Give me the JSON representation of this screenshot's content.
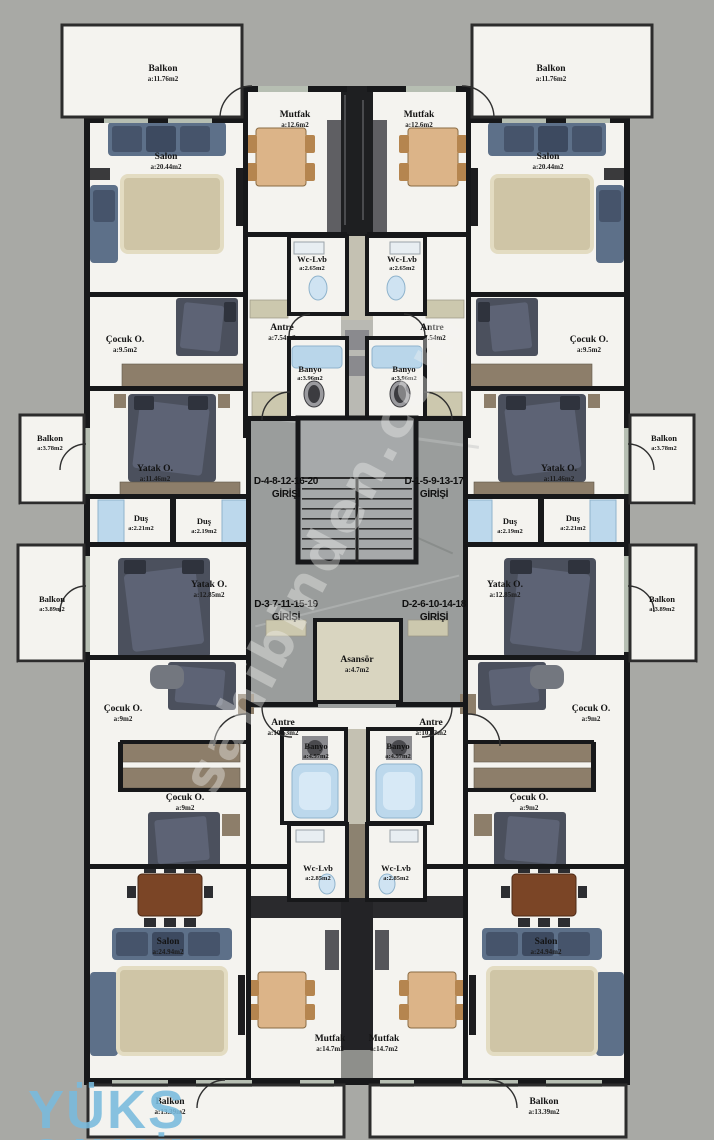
{
  "watermark": "sahibinden.com",
  "logo": {
    "line1": "YÜKS",
    "line2": "GAYRİM"
  },
  "colors": {
    "background": "#a8a9a5",
    "wall": "#17181a",
    "floor": "#f4f3ef",
    "stair_core": "#9a9d9c",
    "elevator_fill": "#d9d5c0",
    "wood": "#8d7e6a",
    "sofa": "#5d7089",
    "bed": "#4b505d",
    "rug": "#cfc5a6",
    "fixture_blue": "#bcd8ec",
    "logo_blue": "#79bbdd"
  },
  "entrances": {
    "top_left": {
      "line1": "D-4-8-12-16-20",
      "line2": "GİRİŞİ"
    },
    "top_right": {
      "line1": "D-1-5-9-13-17",
      "line2": "GİRİŞİ"
    },
    "bottom_left": {
      "line1": "D-3-7-11-15-19",
      "line2": "GİRİŞİ"
    },
    "bottom_right": {
      "line1": "D-2-6-10-14-18",
      "line2": "GİRİŞİ"
    }
  },
  "rooms": {
    "balkon_tl": {
      "name": "Balkon",
      "area": "a:11.76m2"
    },
    "balkon_tr": {
      "name": "Balkon",
      "area": "a:11.76m2"
    },
    "salon_tl": {
      "name": "Salon",
      "area": "a:20.44m2"
    },
    "salon_tr": {
      "name": "Salon",
      "area": "a:20.44m2"
    },
    "mutfak_tl": {
      "name": "Mutfak",
      "area": "a:12.6m2"
    },
    "mutfak_tr": {
      "name": "Mutfak",
      "area": "a:12.6m2"
    },
    "wclvb_tl": {
      "name": "Wc-Lvb",
      "area": "a:2.65m2"
    },
    "wclvb_tr": {
      "name": "Wc-Lvb",
      "area": "a:2.65m2"
    },
    "antre_tl": {
      "name": "Antre",
      "area": "a:7.54m2"
    },
    "antre_tr": {
      "name": "Antre",
      "area": "a:7.54m2"
    },
    "banyo_tl": {
      "name": "Banyo",
      "area": "a:3.96m2"
    },
    "banyo_tr": {
      "name": "Banyo",
      "area": "a:3.96m2"
    },
    "cocuk_tl": {
      "name": "Çocuk O.",
      "area": "a:9.5m2"
    },
    "cocuk_tr": {
      "name": "Çocuk O.",
      "area": "a:9.5m2"
    },
    "balkon_ml1": {
      "name": "Balkon",
      "area": "a:3.78m2"
    },
    "balkon_mr1": {
      "name": "Balkon",
      "area": "a:3.78m2"
    },
    "yatak_tl": {
      "name": "Yatak O.",
      "area": "a:11.46m2"
    },
    "yatak_tr": {
      "name": "Yatak O.",
      "area": "a:11.46m2"
    },
    "dus_l1": {
      "name": "Duş",
      "area": "a:2.21m2"
    },
    "dus_l2": {
      "name": "Duş",
      "area": "a:2.19m2"
    },
    "dus_r1": {
      "name": "Duş",
      "area": "a:2.19m2"
    },
    "dus_r2": {
      "name": "Duş",
      "area": "a:2.21m2"
    },
    "yatak_ml": {
      "name": "Yatak O.",
      "area": "a:12.85m2"
    },
    "yatak_mr": {
      "name": "Yatak O.",
      "area": "a:12.85m2"
    },
    "balkon_ml2": {
      "name": "Balkon",
      "area": "a:3.89m2"
    },
    "balkon_mr2": {
      "name": "Balkon",
      "area": "a:3.89m2"
    },
    "asansor": {
      "name": "Asansör",
      "area": "a:4.7m2"
    },
    "cocuk_ml1": {
      "name": "Çocuk O.",
      "area": "a:9m2"
    },
    "cocuk_mr1": {
      "name": "Çocuk O.",
      "area": "a:9m2"
    },
    "antre_bl": {
      "name": "Antre",
      "area": "a:10.53m2"
    },
    "antre_br": {
      "name": "Antre",
      "area": "a:10.53m2"
    },
    "banyo_bl": {
      "name": "Banyo",
      "area": "a:4.57m2"
    },
    "banyo_br": {
      "name": "Banyo",
      "area": "a:4.57m2"
    },
    "cocuk_ml2": {
      "name": "Çocuk O.",
      "area": "a:9m2"
    },
    "cocuk_mr2": {
      "name": "Çocuk O.",
      "area": "a:9m2"
    },
    "wclvb_bl": {
      "name": "Wc-Lvb",
      "area": "a:2.85m2"
    },
    "wclvb_br": {
      "name": "Wc-Lvb",
      "area": "a:2.85m2"
    },
    "salon_bl": {
      "name": "Salon",
      "area": "a:24.94m2"
    },
    "salon_br": {
      "name": "Salon",
      "area": "a:24.94m2"
    },
    "mutfak_bl": {
      "name": "Mutfak",
      "area": "a:14.7m2"
    },
    "mutfak_br": {
      "name": "Mutfak",
      "area": "a:14.7m2"
    },
    "balkon_bl": {
      "name": "Balkon",
      "area": "a:13.39m2"
    },
    "balkon_br": {
      "name": "Balkon",
      "area": "a:13.39m2"
    }
  }
}
